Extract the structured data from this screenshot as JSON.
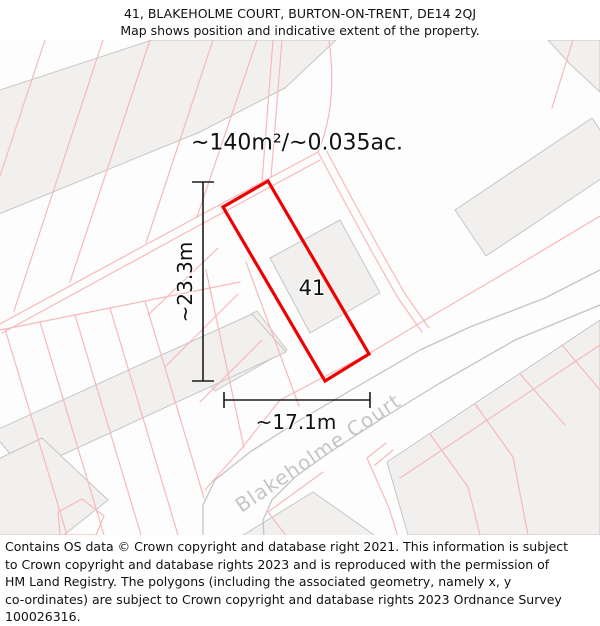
{
  "header": {
    "title": "41, BLAKEHOLME COURT, BURTON-ON-TRENT, DE14 2QJ",
    "subtitle": "Map shows position and indicative extent of the property."
  },
  "map": {
    "area_label": "~140m²/~0.035ac.",
    "plot_number": "41",
    "dim_vertical": "~23.3m",
    "dim_horizontal": "~17.1m",
    "street_name": "Blakeholme Court",
    "colors": {
      "property_outline": "#ee0000",
      "parcel_line": "#f7b9b9",
      "building_fill": "#f1f0ee",
      "building_stroke": "#c6c6c6",
      "road_casing": "#c4c4c4",
      "dimension_line": "#1c1c1c",
      "street_label": "#c5c5c5"
    }
  },
  "footer": {
    "text": "Contains OS data © Crown copyright and database right 2021. This information is subject\nto Crown copyright and database rights 2023 and is reproduced with the permission of\nHM Land Registry. The polygons (including the associated geometry, namely x, y\nco-ordinates) are subject to Crown copyright and database rights 2023 Ordnance Survey\n100026316."
  }
}
